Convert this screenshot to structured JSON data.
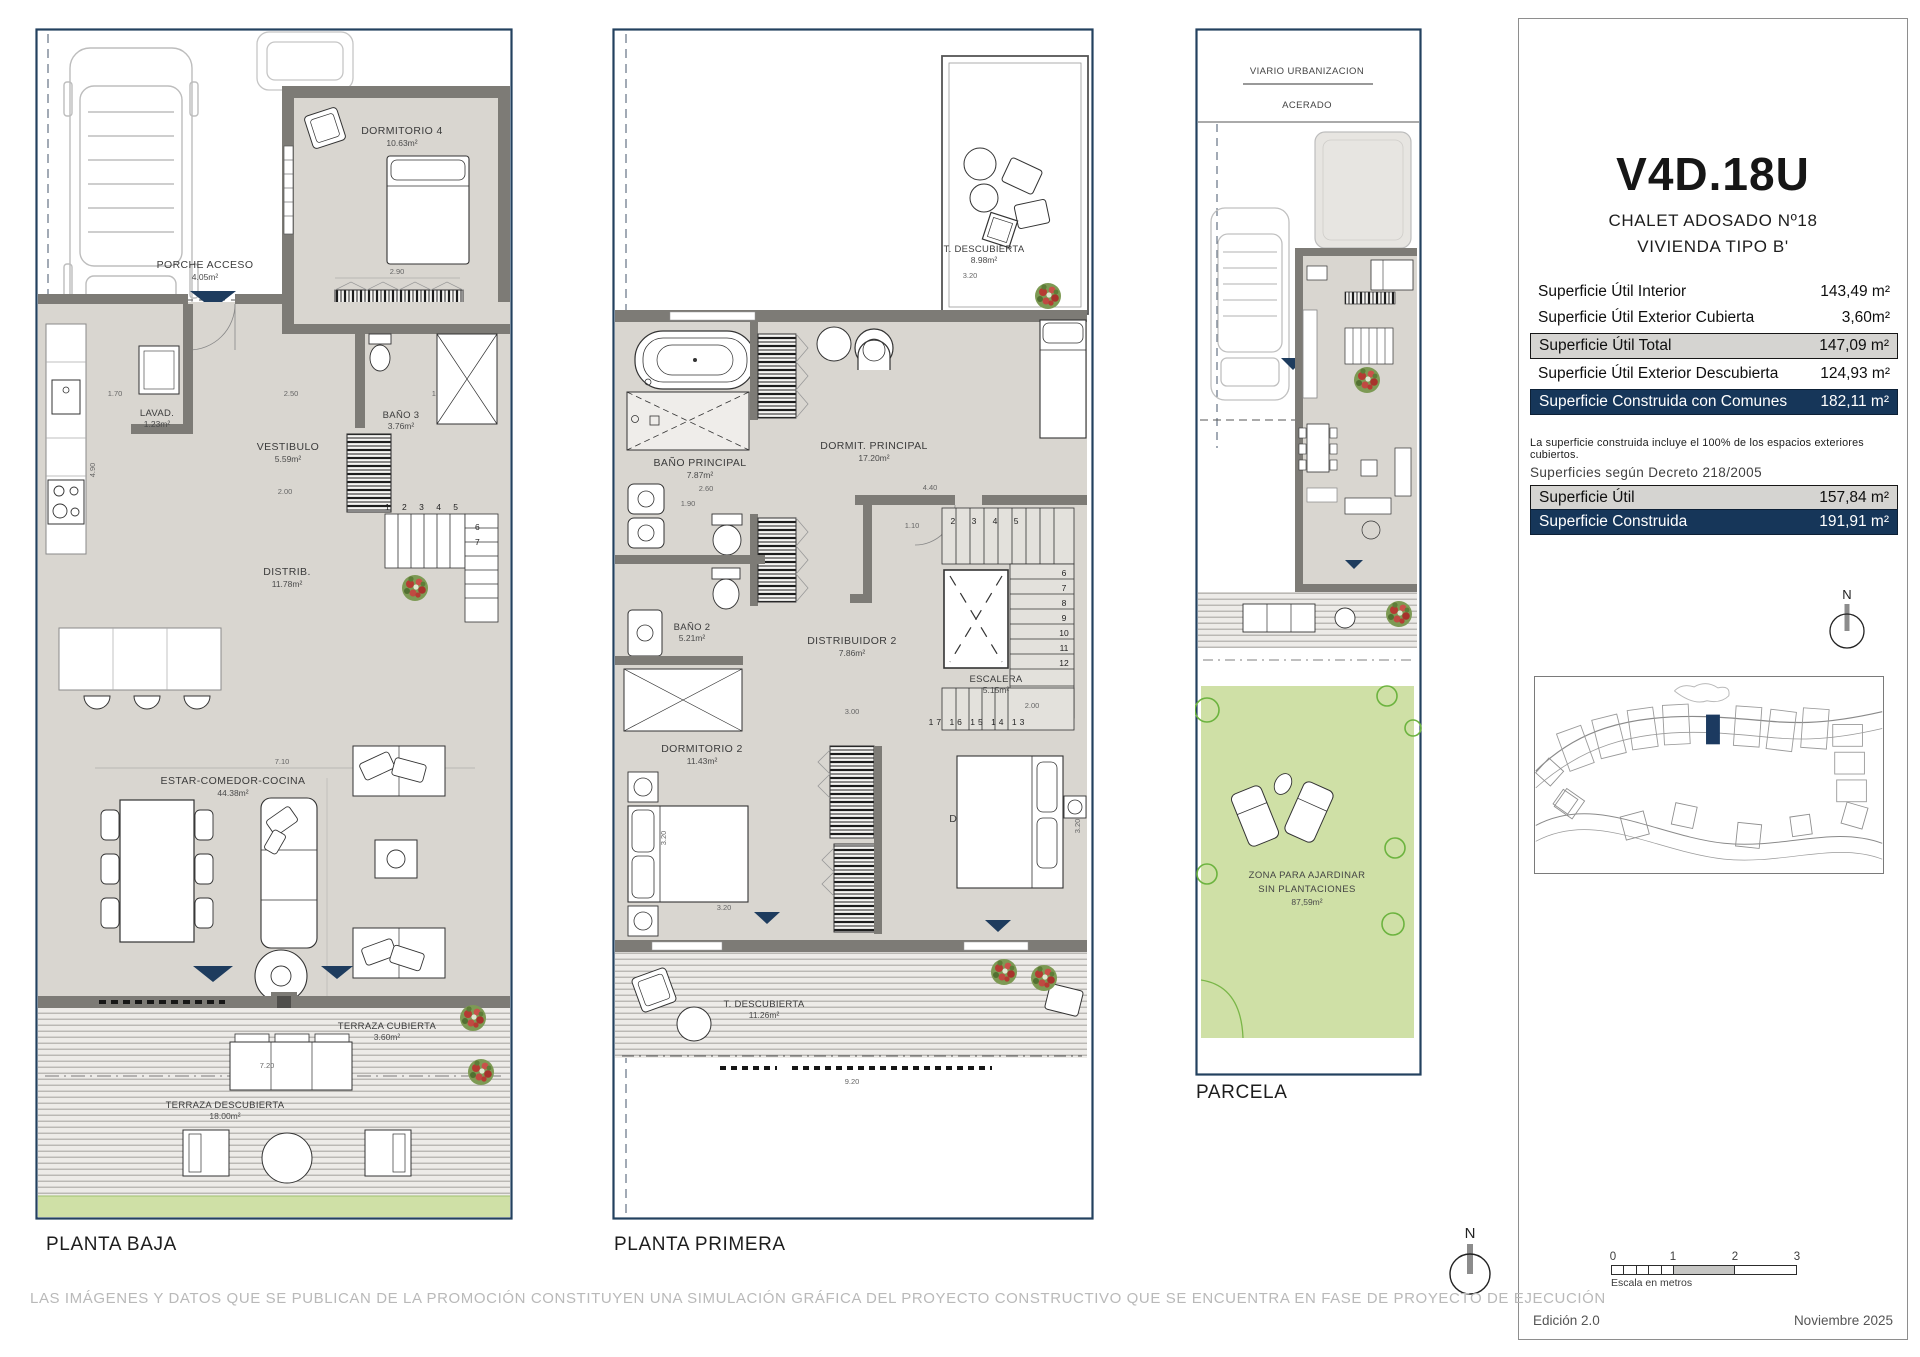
{
  "page": {
    "disclaimer": "LAS IMÁGENES Y DATOS QUE SE PUBLICAN DE LA PROMOCIÓN CONSTITUYEN UNA SIMULACIÓN GRÁFICA DEL PROYECTO CONSTRUCTIVO QUE SE ENCUENTRA EN FASE DE PROYECTO DE EJECUCIÓN"
  },
  "colors": {
    "navy": "#1c3a5f",
    "wall_gray": "#7d7b76",
    "floor_gray": "#d9d6d0",
    "garden_green": "#cfe0a6",
    "row_gray": "#d5d4d1"
  },
  "panel": {
    "title": "V4D.18U",
    "subtitle1": "CHALET ADOSADO Nº18",
    "subtitle2": "VIVIENDA TIPO B'",
    "rows": [
      {
        "label": "Superficie Útil Interior",
        "value": "143,49 m²"
      },
      {
        "label": "Superficie Útil Exterior Cubierta",
        "value": "3,60m²"
      },
      {
        "label": "Superficie Útil Total",
        "value": "147,09 m²"
      },
      {
        "label": "Superficie Útil Exterior Descubierta",
        "value": "124,93 m²"
      },
      {
        "label": "Superficie Construida con Comunes",
        "value": "182,11 m²"
      }
    ],
    "note": "La superficie construida incluye el 100% de los espacios exteriores cubiertos.",
    "decreto": {
      "heading": "Superficies según Decreto 218/2005",
      "rows": [
        {
          "label": "Superficie Útil",
          "value": "157,84 m²"
        },
        {
          "label": "Superficie Construida",
          "value": "191,91 m²"
        }
      ]
    },
    "compass": "N",
    "scale": {
      "t0": "0",
      "t1": "1",
      "t2": "2",
      "t3": "3",
      "caption": "Escala en metros"
    },
    "edition": "Edición 2.0",
    "date": "Noviembre 2025"
  },
  "planta_baja": {
    "label": "PLANTA BAJA",
    "porche": {
      "name": "PORCHE ACCESO",
      "area": "4.05m²"
    },
    "dorm4": {
      "name": "DORMITORIO 4",
      "area": "10.63m²"
    },
    "lavad": {
      "name": "LAVAD.",
      "area": "1.23m²"
    },
    "vestibulo": {
      "name": "VESTIBULO",
      "area": "5.59m²"
    },
    "bano3": {
      "name": "BAÑO 3",
      "area": "3.76m²"
    },
    "distrib": {
      "name": "DISTRIB.",
      "area": "11.78m²"
    },
    "estar": {
      "name": "ESTAR-COMEDOR-COCINA",
      "area": "44.38m²"
    },
    "terraza_cubierta": {
      "name": "TERRAZA CUBIERTA",
      "area": "3.60m²"
    },
    "terraza_descubierta": {
      "name": "TERRAZA DESCUBIERTA",
      "area": "18.00m²"
    },
    "stairs_top": "1 2 3 4 5",
    "stairs_side": [
      "6",
      "7"
    ],
    "dims": {
      "a": "1.70",
      "b": "2.50",
      "c": "1.70",
      "d": "2.90",
      "e": "2.00",
      "f": "4.90",
      "g": "7.10",
      "h": "10.10",
      "i": "7.20"
    }
  },
  "planta_primera": {
    "label": "PLANTA PRIMERA",
    "terraza_sup": {
      "name": "T. DESCUBIERTA",
      "area": "8.98m²"
    },
    "bano_ppal": {
      "name": "BAÑO PRINCIPAL",
      "area": "7.87m²"
    },
    "dormit_ppal": {
      "name": "DORMIT. PRINCIPAL",
      "area": "17.20m²"
    },
    "bano2": {
      "name": "BAÑO 2",
      "area": "5.21m²"
    },
    "distribuidor2": {
      "name": "DISTRIBUIDOR 2",
      "area": "7.86m²"
    },
    "escalera": {
      "name": "ESCALERA",
      "area": "5.15m²"
    },
    "dorm2": {
      "name": "DORMITORIO 2",
      "area": "11.43m²"
    },
    "dorm3": {
      "name": "DORMITORIO 3",
      "area": "11.33m²"
    },
    "terraza_inf": {
      "name": "T. DESCUBIERTA",
      "area": "11.26m²"
    },
    "stairs_top": "2 3 4 5",
    "stairs_right": [
      "6",
      "7",
      "8",
      "9",
      "10",
      "11",
      "12"
    ],
    "stairs_bottom": "17 16 15 14 13",
    "dims": {
      "t320": "3.20",
      "d260": "2.60",
      "d190": "1.90",
      "d440": "4.40",
      "d110": "1.10",
      "d300": "3.00",
      "d200": "2.00",
      "v320a": "3.20",
      "h320": "3.20",
      "v320b": "3.20",
      "d920": "9.20"
    }
  },
  "parcela": {
    "label": "PARCELA",
    "viario": "VIARIO URBANIZACION",
    "acerado": "ACERADO",
    "zona_line1": "ZONA PARA AJARDINAR",
    "zona_line2": "SIN PLANTACIONES",
    "zona_area": "87,59m²"
  }
}
